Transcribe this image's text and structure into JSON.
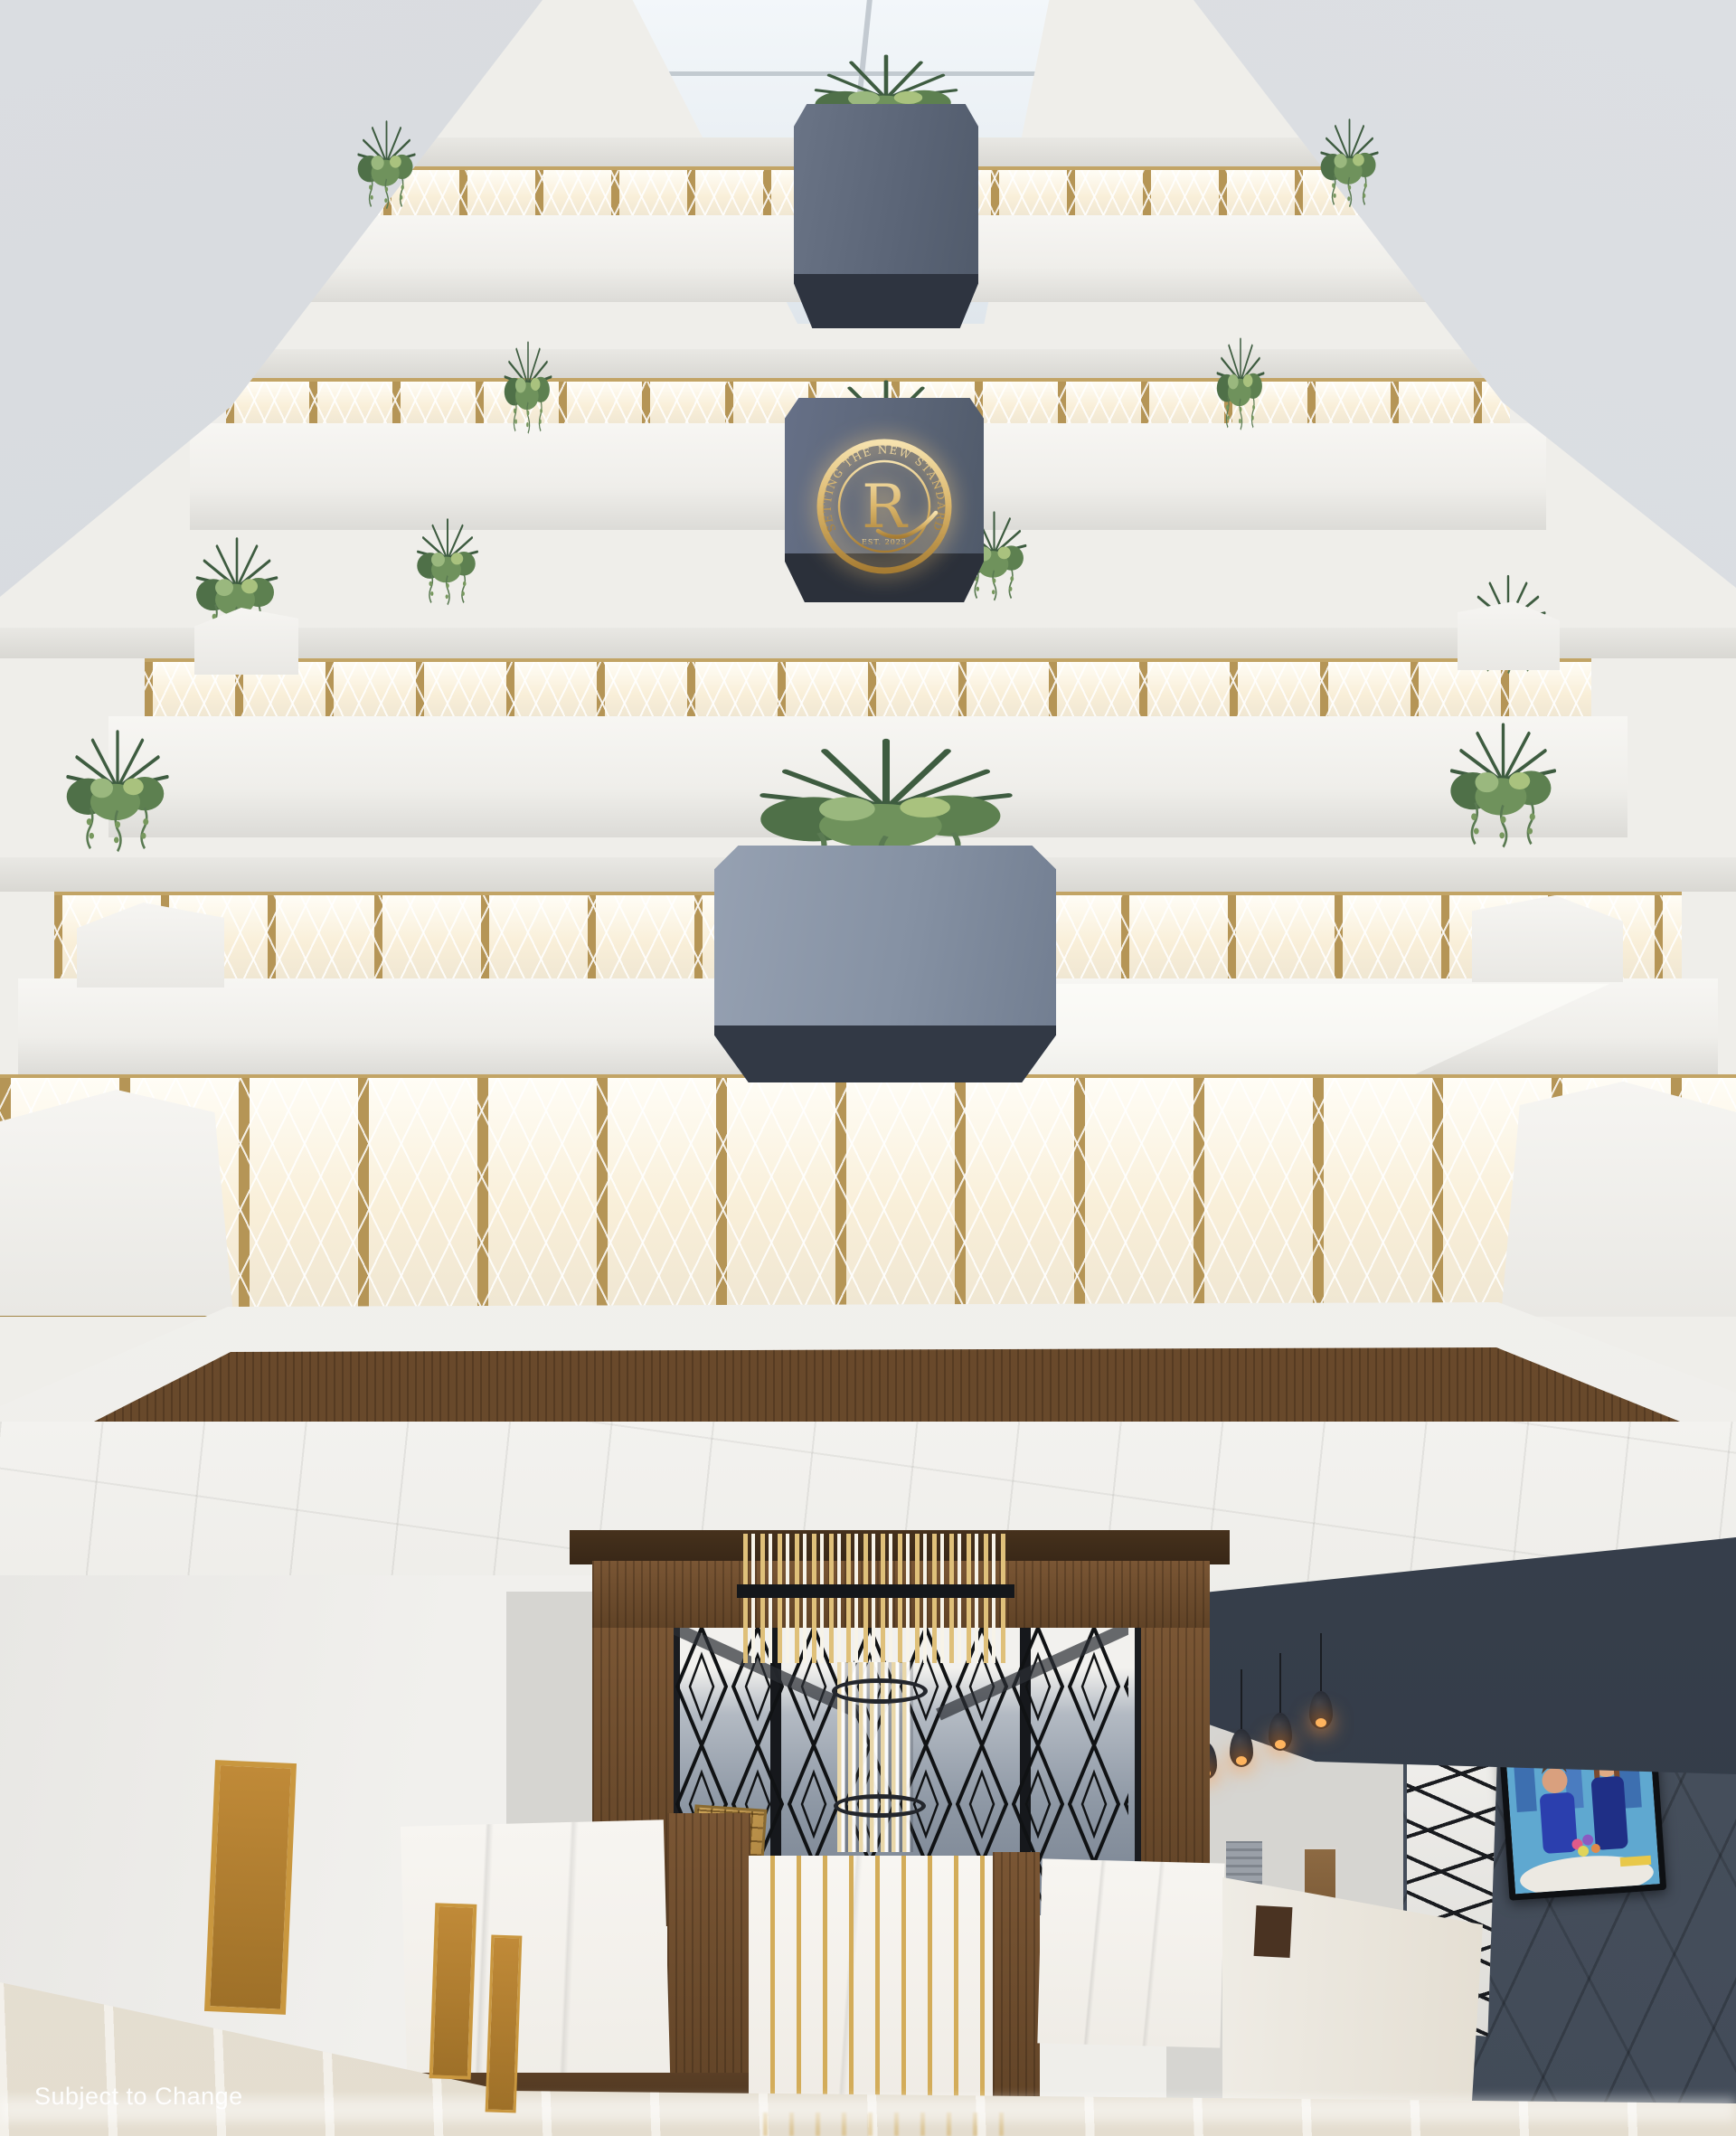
{
  "scene": {
    "type": "architectural rendering",
    "subject": "hotel atrium lobby, upward interior view",
    "watermark": {
      "text": "Subject to Change"
    },
    "logo": {
      "ring_text": "SETTING THE NEW STANDARD",
      "monogram": "R",
      "established": "EST. 2023"
    },
    "palette": {
      "gold": "#b59556",
      "gold_light": "#e9d5a3",
      "planter_light": "#8591a3",
      "planter_navy": "#5b6577",
      "planter_base_dark": "#2f3540",
      "railing_white": "#f6f4ef",
      "wood": "#6b4a2c",
      "wood_dark": "#46301d",
      "wall_dark": "#49525f",
      "soffit_dark": "#39414e",
      "ceiling_white": "#f2f1ee",
      "side_wall_gray": "#d8dbdf",
      "floor": "#e9e4d9",
      "marble_white": "#f4f2ee",
      "foliage_dark": "#3e5c40",
      "foliage_light": "#7fa05a",
      "pendant_glow": "#ffb45e",
      "tv_sky": "#9fd9e8",
      "watermark_color": "#ffffff"
    }
  }
}
